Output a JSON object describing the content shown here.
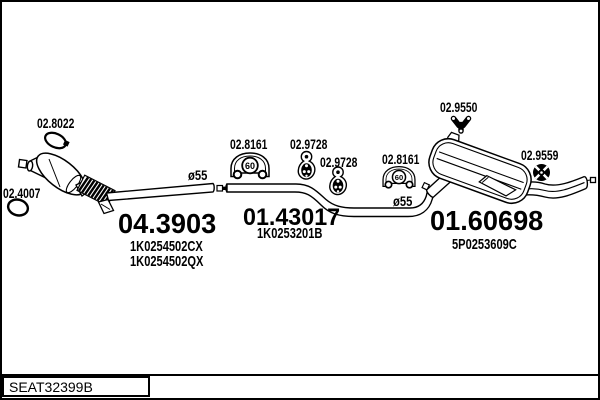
{
  "colors": {
    "ink": "#000000",
    "background": "#ffffff"
  },
  "labels": {
    "gasket_front": "02.8022",
    "ring_front": "02.4007",
    "clamp": "02.8161",
    "hanger": "02.9728",
    "hanger_rear": "02.9550",
    "grommet_rear": "02.9559",
    "diameter": "ø55",
    "clamp_size": "60"
  },
  "sections": {
    "front": {
      "code": "04.3903",
      "variants": [
        "1K0254502CX",
        "1K0254502QX"
      ]
    },
    "middle": {
      "code": "01.43017",
      "variants": [
        "1K0253201B"
      ]
    },
    "rear": {
      "code": "01.60698",
      "variants": [
        "5P0253609C"
      ]
    }
  },
  "footer": {
    "sheet_code": "SEAT32399B"
  },
  "icons": {
    "gasket_front": "gasket-ring-icon",
    "ring_front": "seal-ring-icon",
    "clamp": "pipe-clamp-60-icon",
    "hanger": "rubber-hanger-icon",
    "hanger_rear": "y-rubber-mount-icon",
    "grommet_rear": "rubber-grommet-icon"
  }
}
